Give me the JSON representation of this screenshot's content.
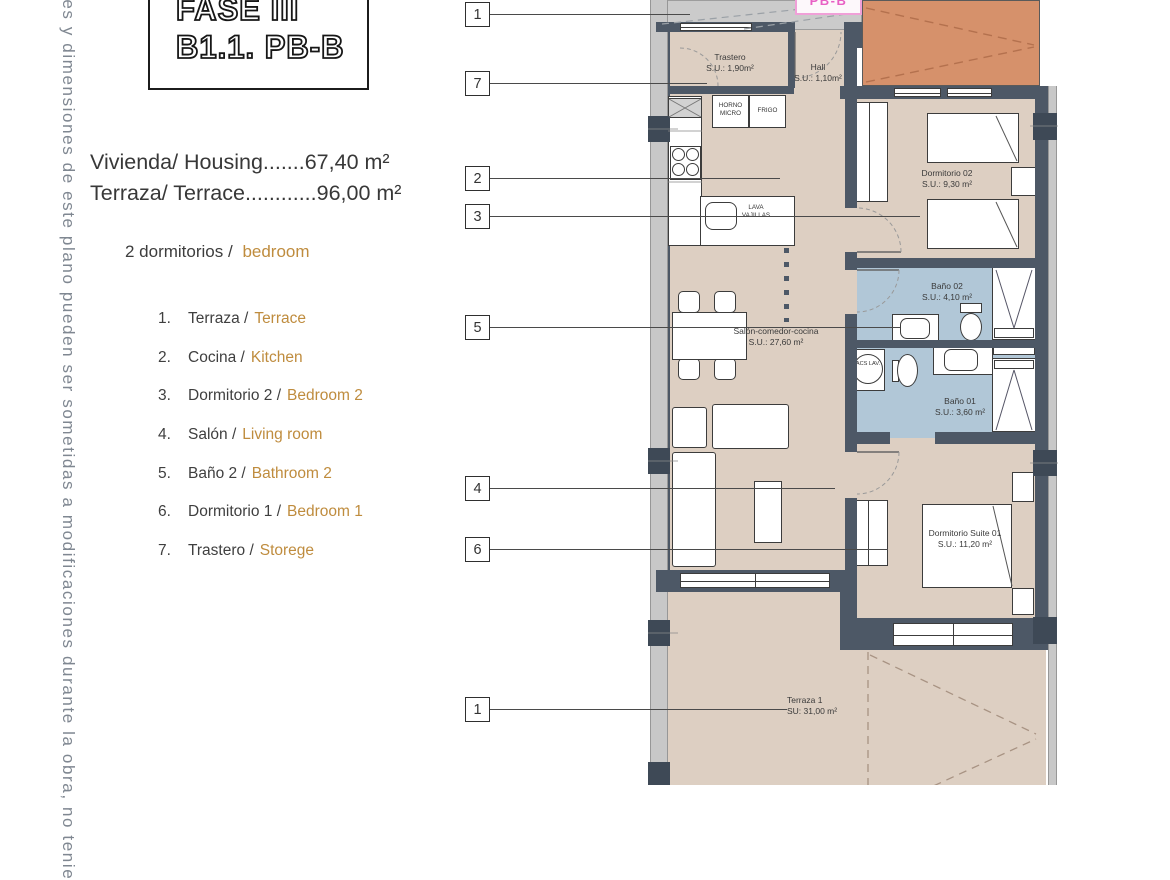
{
  "page": {
    "side_note": "ies y dimensiones de este plano pueden ser sometidas a modificaciones durante la obra, no tenie",
    "title_line1": "FASE III",
    "title_line2": "B1.1. PB-B",
    "area_line1": "Vivienda/ Housing.......67,40 m²",
    "area_line2": "Terraza/ Terrace............96,00 m²",
    "summary_prefix": "2 dormitorios /",
    "summary_highlight": "bedroom"
  },
  "legend": {
    "items": [
      {
        "num": "1.",
        "es": "Terraza /",
        "en": "Terrace"
      },
      {
        "num": "2.",
        "es": "Cocina /",
        "en": "Kitchen"
      },
      {
        "num": "3.",
        "es": "Dormitorio 2 /",
        "en": "Bedroom 2"
      },
      {
        "num": "4.",
        "es": "Salón /",
        "en": "Living room"
      },
      {
        "num": "5.",
        "es": "Baño 2 /",
        "en": "Bathroom 2"
      },
      {
        "num": "6.",
        "es": "Dormitorio 1 /",
        "en": "Bedroom 1"
      },
      {
        "num": "7.",
        "es": "Trastero /",
        "en": "Storege"
      }
    ]
  },
  "plan": {
    "sheet_tag": "PB-B",
    "callouts": [
      {
        "label": "1"
      },
      {
        "label": "7"
      },
      {
        "label": "2"
      },
      {
        "label": "3"
      },
      {
        "label": "5"
      },
      {
        "label": "4"
      },
      {
        "label": "6"
      },
      {
        "label": "1"
      }
    ],
    "rooms": {
      "trastero": {
        "name": "Trastero",
        "area": "S.U.: 1,90m²"
      },
      "hall": {
        "name": "Hall",
        "area": "S.U.: 1,10m²"
      },
      "dorm02": {
        "name": "Dormitorio 02",
        "area": "S.U.: 9,30 m²"
      },
      "bano02": {
        "name": "Baño 02",
        "area": "S.U.: 4,10 m²"
      },
      "salon": {
        "name": "Salón-comedor-cocina",
        "area": "S.U.: 27,60 m²"
      },
      "bano01": {
        "name": "Baño 01",
        "area": "S.U.: 3,60 m²"
      },
      "suite": {
        "name": "Dormitorio Suite 01",
        "area": "S.U.: 11,20 m²"
      },
      "terraza": {
        "name": "Terraza 1",
        "area": "SU: 31,00 m²"
      }
    },
    "appliances": {
      "horno": "HORNO MICRO",
      "frigo": "FRIGO",
      "lava": "LAVA VAJILLAS",
      "acs": "ACS LAV."
    }
  },
  "colors": {
    "accent_text": "#bf8c3e",
    "wall": "#4d5866",
    "floor": "#ddcfc2",
    "bathroom_floor": "#b1c7d7",
    "terrace_orange": "#d6916b",
    "tag_pink": "#e85fc4"
  }
}
